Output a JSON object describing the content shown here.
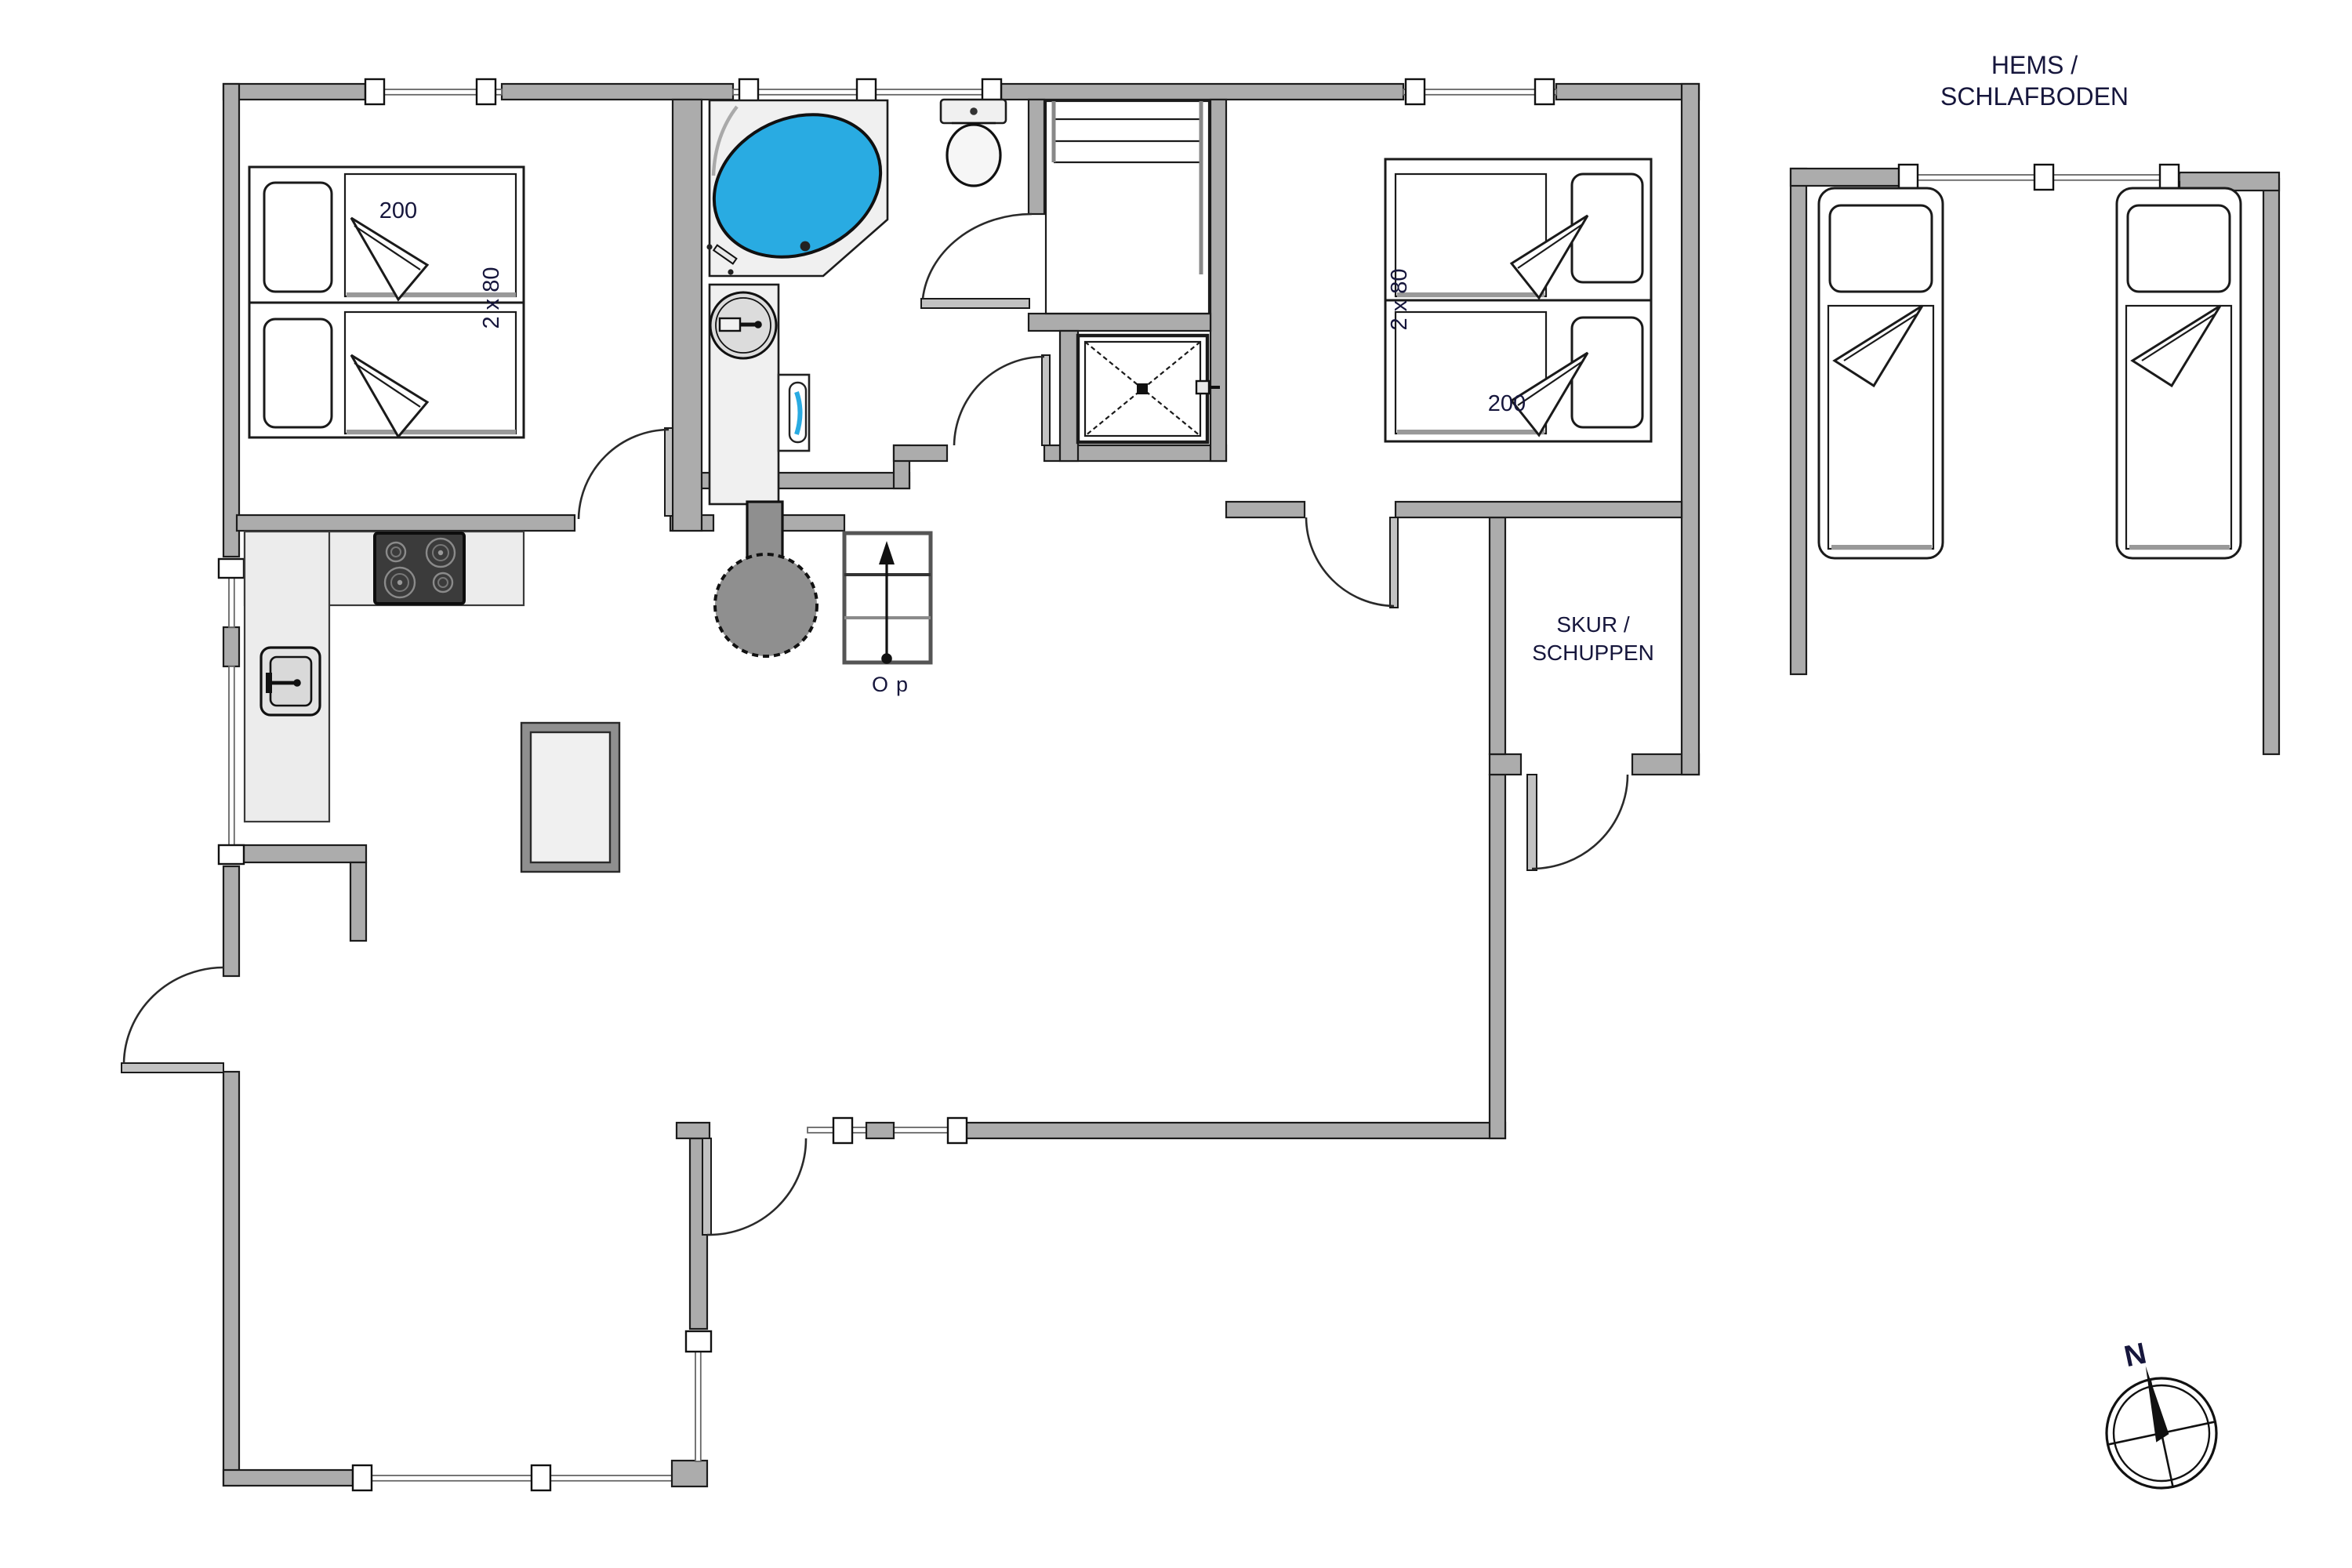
{
  "labels": {
    "hems_line1": "HEMS /",
    "hems_line2": "SCHLAFBODEN",
    "skur_line1": "SKUR /",
    "skur_line2": "SCHUPPEN",
    "bedroom_left_length": "200",
    "bedroom_left_width": "2 x 80",
    "bedroom_right_width": "2 x 80",
    "bedroom_right_length": "200",
    "stairs_direction": "Op",
    "compass_north": "N"
  },
  "colors": {
    "wall": "#ACACAC",
    "wall_outline": "#1c1c1c",
    "fixture_fill": "#F0F0F0",
    "counter_fill": "#ECECEC",
    "tub_water": "#29ABE2",
    "hob_dark": "#3B3B3B",
    "stove_gray": "#8F8F8F",
    "label_text": "#16163C",
    "floor": "#FFFFFF"
  },
  "icons": {
    "compass": "compass-rose-icon",
    "north_needle": "north-needle-icon",
    "stairs_arrow": "up-arrow-icon"
  }
}
